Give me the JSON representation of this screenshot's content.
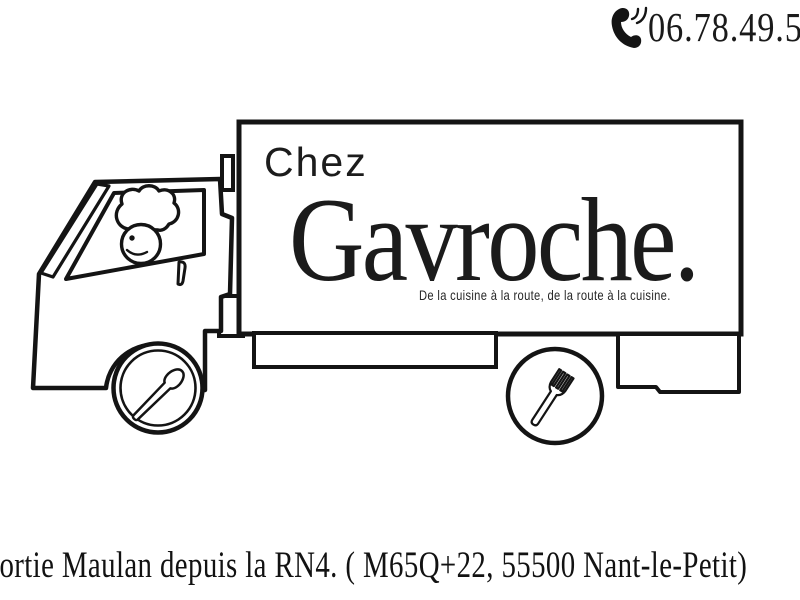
{
  "colors": {
    "background": "#ffffff",
    "ink": "#1a1a1a",
    "line": "#141414"
  },
  "header": {
    "phone_number": "06.78.49.5"
  },
  "sign": {
    "prefix": "Chez",
    "brand": "Gavroche.",
    "tagline": "De la cuisine à la route, de la route à la cuisine."
  },
  "footer": {
    "directions": "Sortie Maulan depuis la RN4. ( M65Q+22, 55500 Nant-le-Petit)"
  },
  "icons": {
    "phone": "phone-handset-icon",
    "front_wheel": "spoon-icon",
    "rear_wheel": "fork-icon",
    "driver": "chef-character-icon"
  }
}
